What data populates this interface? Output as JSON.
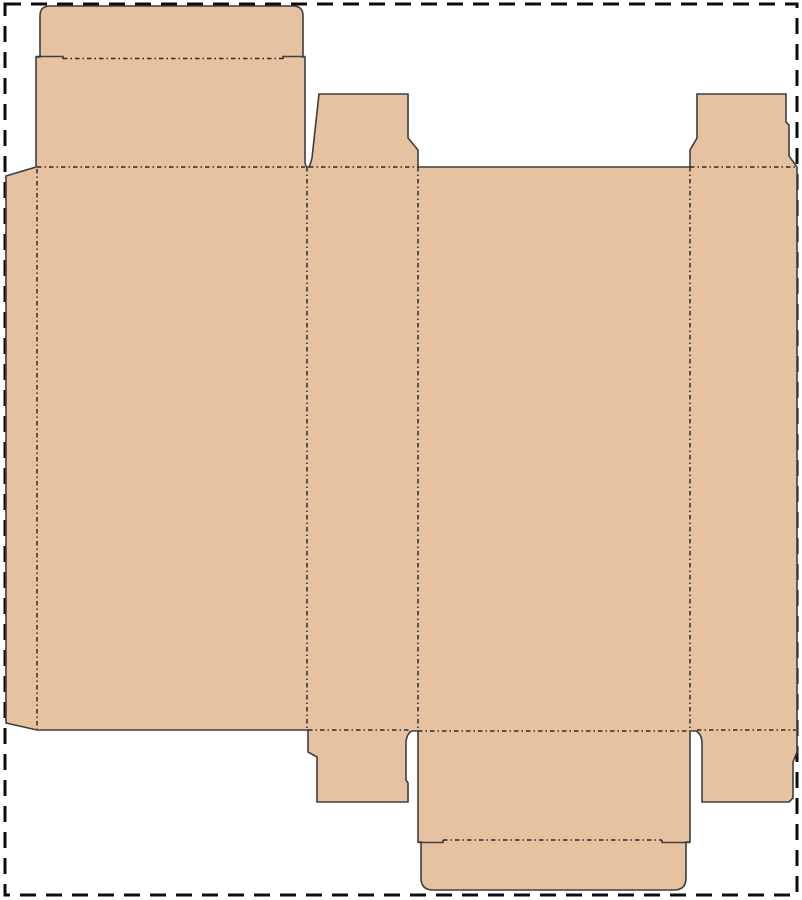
{
  "canvas": {
    "width": 802,
    "height": 900,
    "background": "#ffffff"
  },
  "border": {
    "d": "M 5,4 L 797,4 L 797,895 L 5,895 Z",
    "color": "#0d0d0d",
    "stroke_width": 3,
    "dash": "16 10"
  },
  "dieline": {
    "material_fill": "#e6c2a0",
    "cut_color": "#3e3e3e",
    "cut_width": 1.6,
    "fold_color": "#2b2b31",
    "fold_width": 1.5,
    "fold_dash": "4.5 3 1.5 3",
    "outline_path": "M 36,167 L 36,57 L 40,57 L 40,16 Q 40,6 50,6 L 293,6 Q 303,6 303,16 L 303,57 L 305,57 L 305,160 Q 305,166 307,167 L 309,167 Q 311,163 312,158 L 319,94 L 408,94 L 408,138 L 418,150 L 418,167 L 690,167 L 690,150 L 697,138 L 697,94 L 786,94 L 786,122 L 789,125 L 789,156 L 797,167 L 797,752 L 793,762 L 793,798 L 789,802 L 702,802 L 702,744 Q 702,734 696,731 L 690,731 L 690,842 L 686,842 L 686,878 Q 686,890 674,890 L 433,890 Q 421,890 421,878 L 421,842 L 418,842 L 418,731 L 412,731 Q 407,733 406,742 L 406,780 L 408,783 L 408,802 L 317,802 L 317,757 L 308,752 L 308,730 L 37,730 L 6,723 L 6,176 Z",
    "slits_path": "M 36,56.5 L 63,56.5 L 63,59 M 283,59 L 283,56.5 L 305,56.5 M 418,842.5 L 443,842.5 L 443,840 M 662,840 L 662,842.5 L 690,842.5",
    "fold_paths": [
      {
        "name": "glue-flap-fold",
        "d": "M 37,169 L 37,729"
      },
      {
        "name": "panel-a-b-fold",
        "d": "M 307,167 L 307,730"
      },
      {
        "name": "panel-b-c-fold",
        "d": "M 418,167 L 418,730"
      },
      {
        "name": "panel-c-d-fold",
        "d": "M 690,167 L 690,730"
      },
      {
        "name": "top-lid-fold",
        "d": "M 37,167 L 305,167"
      },
      {
        "name": "top-dust-flap-b-fold",
        "d": "M 309,167 L 418,167"
      },
      {
        "name": "top-dust-flap-d-fold",
        "d": "M 690,167 L 796,167"
      },
      {
        "name": "top-tuck-fold",
        "d": "M 63,58.5 L 283,58.5"
      },
      {
        "name": "bottom-dust-flap-b-fold",
        "d": "M 308,730 L 411,730"
      },
      {
        "name": "bottom-lid-fold",
        "d": "M 418,731 L 690,731"
      },
      {
        "name": "bottom-dust-flap-d-fold",
        "d": "M 697,730 L 796,730"
      },
      {
        "name": "bottom-tuck-fold",
        "d": "M 443,840 L 662,840"
      }
    ]
  }
}
